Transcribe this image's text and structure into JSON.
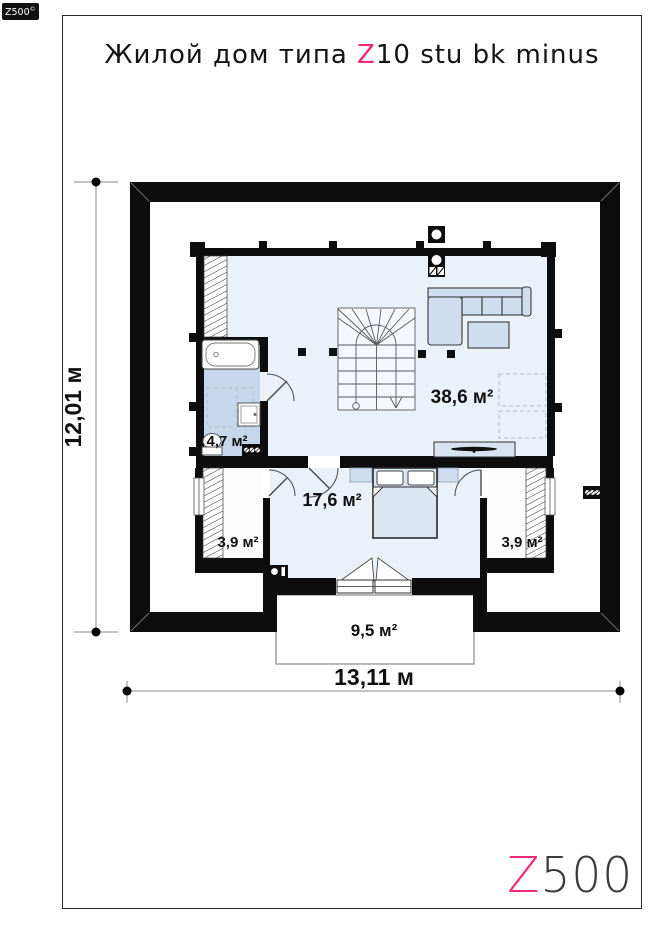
{
  "page": {
    "badge": {
      "text": "Z500",
      "sup": "©"
    },
    "title": {
      "prefix": "Жилой дом типа ",
      "accent": "Z",
      "suffix": "10 stu bk minus"
    },
    "logo": {
      "accent": "Z",
      "rest": "500"
    }
  },
  "plan": {
    "rooms": [
      {
        "name": "living-room",
        "label": "38,6 м²"
      },
      {
        "name": "bathroom",
        "label": "4,7 м²"
      },
      {
        "name": "bedroom",
        "label": "17,6 м²"
      },
      {
        "name": "closet-left",
        "label": "3,9 м²"
      },
      {
        "name": "closet-right",
        "label": "3,9 м²"
      },
      {
        "name": "balcony",
        "label": "9,5 м²"
      }
    ],
    "dimensions": {
      "height": "12,01 м",
      "width": "13,11 м"
    },
    "colors": {
      "accent": "#ee2a7b",
      "wall": "#0d0d0d",
      "floor": "#ebf1f9",
      "bathroom_floor": "#c7d7eb",
      "furniture": "#cfdeef"
    }
  }
}
